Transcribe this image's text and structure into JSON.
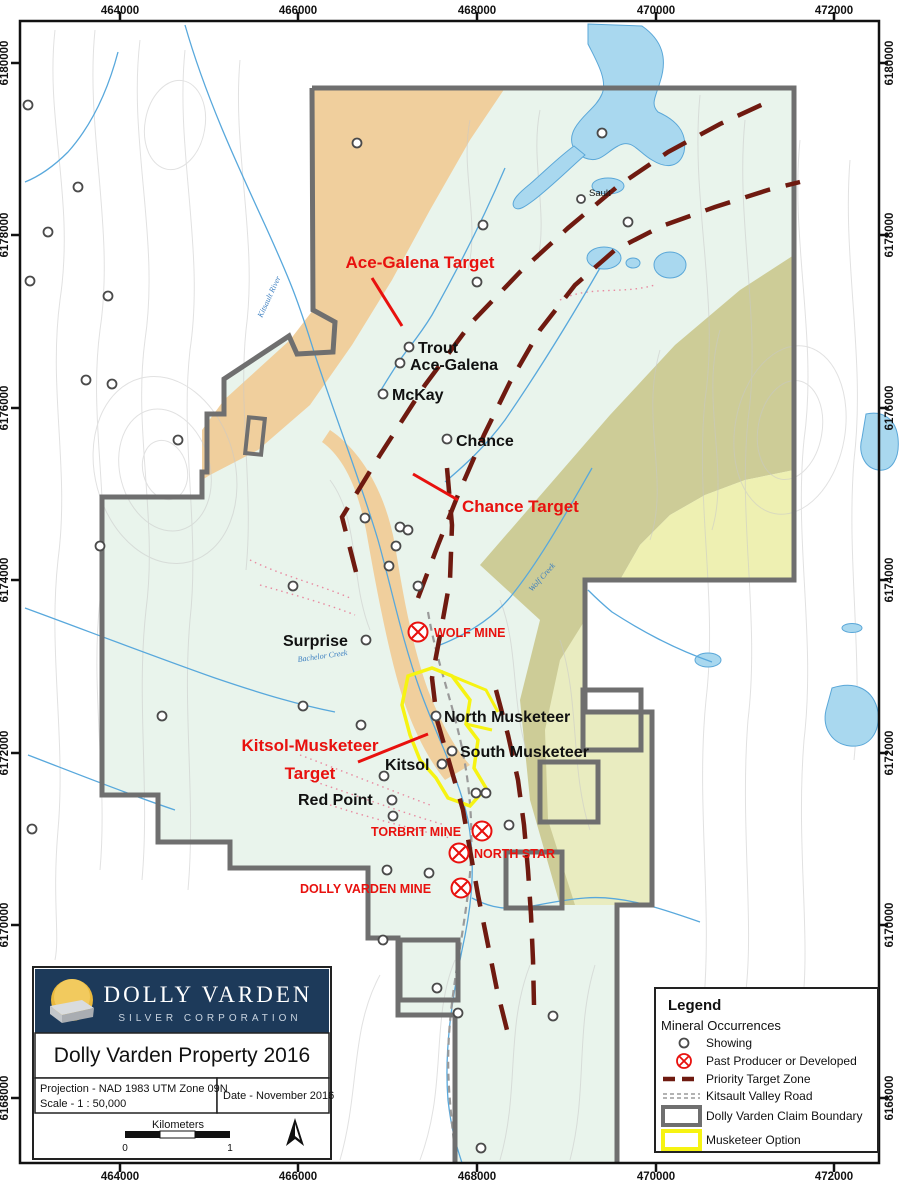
{
  "frame": {
    "top_labels": [
      "464000",
      "466000",
      "468000",
      "470000",
      "472000"
    ],
    "side_labels": [
      "6180000",
      "6178000",
      "6176000",
      "6174000",
      "6172000",
      "6170000",
      "6168000"
    ]
  },
  "targets": {
    "ace_galena": "Ace-Galena Target",
    "chance": "Chance Target",
    "kitsol_line1": "Kitsol-Musketeer",
    "kitsol_line2": "Target"
  },
  "places": {
    "sault": "Sault",
    "trout": "Trout",
    "ace_galena": "Ace-Galena",
    "mckay": "McKay",
    "chance": "Chance",
    "surprise": "Surprise",
    "north_musketeer": "North Musketeer",
    "south_musketeer": "South Musketeer",
    "kitsol": "Kitsol",
    "red_point": "Red Point"
  },
  "mines": {
    "wolf": "WOLF MINE",
    "torbrit": "TORBRIT MINE",
    "north_star": "NORTH STAR",
    "dolly_varden": "DOLLY VARDEN MINE"
  },
  "creeks": {
    "kitsault_river": "Kitsault River",
    "wolf_creek": "Wolf Creek",
    "bachelor_creek": "Bachelor Creek"
  },
  "legend": {
    "title": "Legend",
    "subtitle": "Mineral Occurrences",
    "items": [
      {
        "label": "Showing"
      },
      {
        "label": "Past Producer or Developed"
      },
      {
        "label": "Priority Target Zone"
      },
      {
        "label": "Kitsault Valley Road"
      },
      {
        "label": "Dolly Varden Claim Boundary"
      },
      {
        "label": "Musketeer Option"
      }
    ]
  },
  "title_block": {
    "company_line1": "DOLLY VARDEN",
    "company_line2": "SILVER CORPORATION",
    "map_title": "Dolly Varden Property 2016",
    "projection": "Projection - NAD 1983 UTM Zone 09N",
    "scale": "Scale - 1 : 50,000",
    "date": "Date - November 2016",
    "scalebar_unit": "Kilometers",
    "scalebar_start": "0",
    "scalebar_end": "1"
  },
  "colors": {
    "claim_fill": "#e9f4ec",
    "tan": "#f0cf9d",
    "olive": "#cdcc97",
    "light_yellow": "#eef0b2",
    "lake": "#a9d8ef",
    "lake_edge": "#5aa7d8",
    "target_zone": "#6f1a10",
    "red_label": "#e8110e",
    "boundary_gray": "#6f6f6f",
    "musketeer_yellow": "#f6f312",
    "logo_navy": "#1d3a5a"
  }
}
